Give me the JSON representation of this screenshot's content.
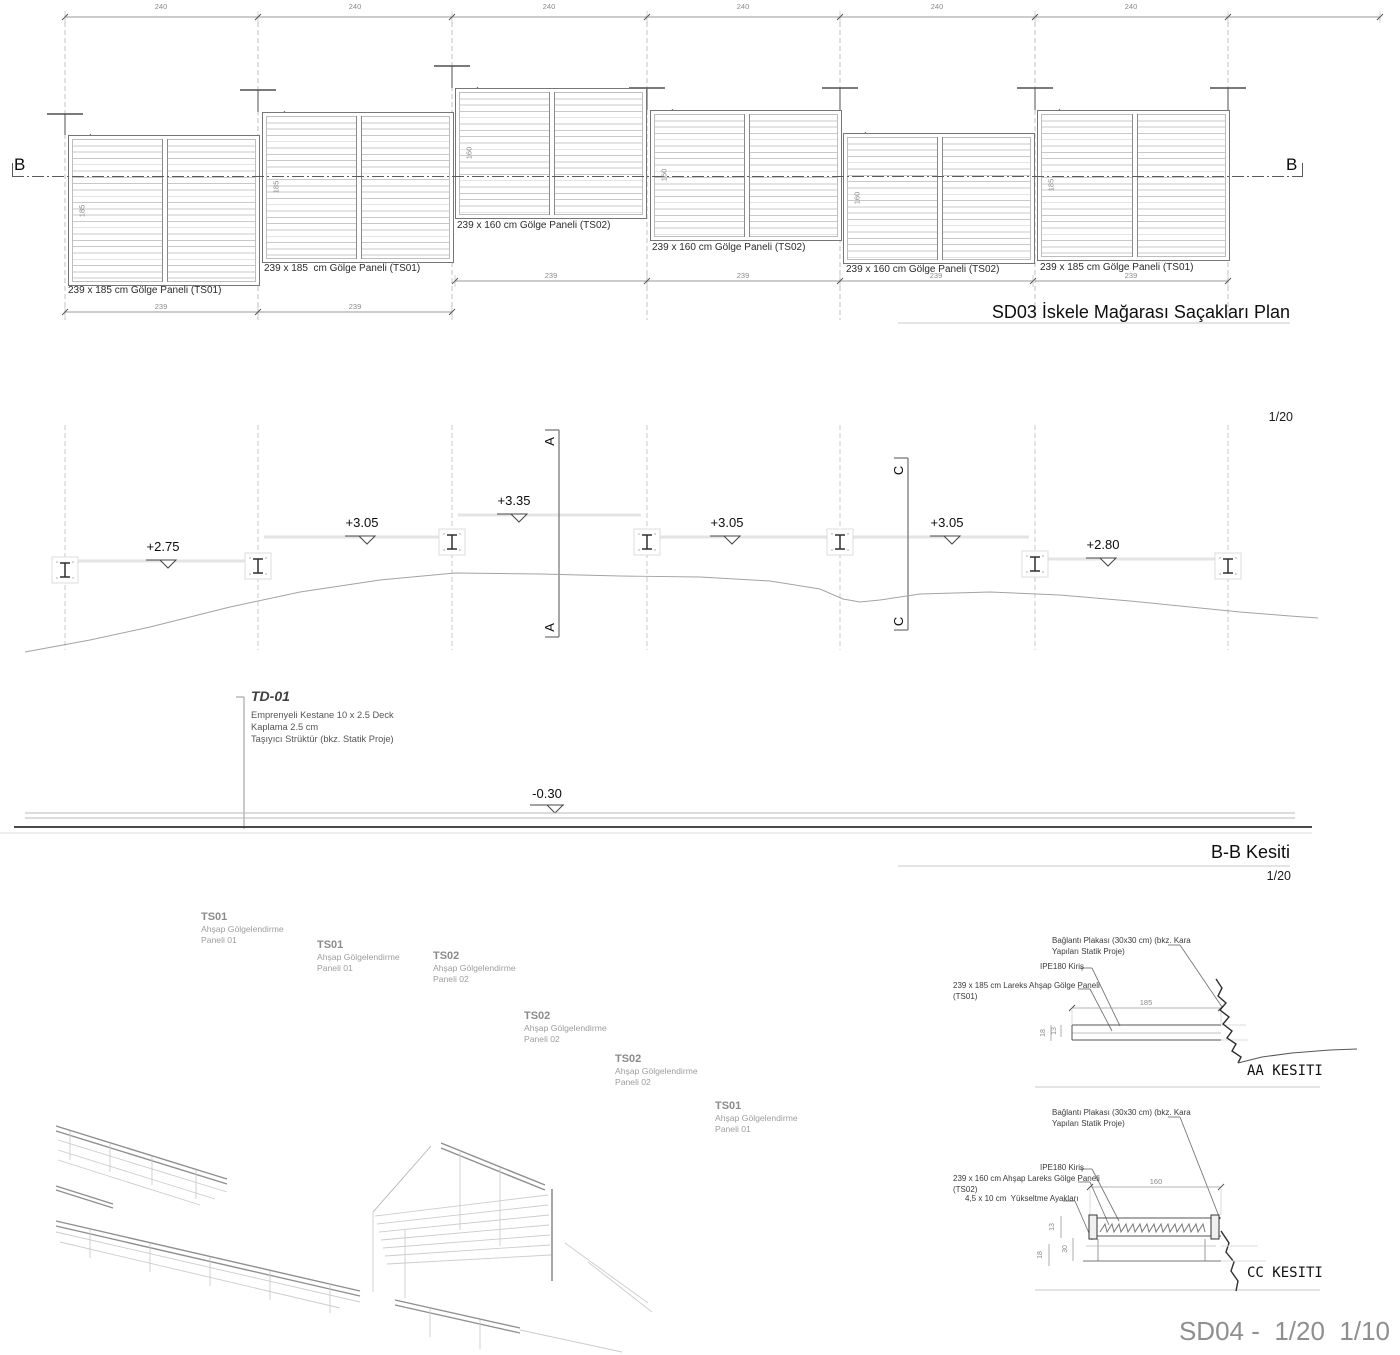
{
  "colors": {
    "ink": "#1a1a1a",
    "dim_gray": "#8a8a8a",
    "footer_gray": "#8f8f8f"
  },
  "plan": {
    "title": "SD03 İskele Mağarası Saçakları Plan",
    "scale": "1/20",
    "marker": "B",
    "top_dims": [
      "240",
      "240",
      "240",
      "240",
      "240",
      "240"
    ],
    "panels": [
      {
        "label": "239 x 185 cm Gölge Paneli (TS01)",
        "depth": "185",
        "width": "239"
      },
      {
        "label": "239 x 185  cm Gölge Paneli (TS01)",
        "depth": "185",
        "width": "239"
      },
      {
        "label": "239 x 160 cm Gölge Paneli (TS02)",
        "depth": "160",
        "width": "239"
      },
      {
        "label": "239 x 160 cm Gölge Paneli (TS02)",
        "depth": "160",
        "width": "239"
      },
      {
        "label": "239 x 160 cm Gölge Paneli (TS02)",
        "depth": "160",
        "width": "239"
      },
      {
        "label": "239 x 185 cm Gölge Paneli (TS01)",
        "depth": "185",
        "width": "239"
      }
    ]
  },
  "section": {
    "title": "B-B Kesiti",
    "scale": "1/20",
    "elevations": [
      "+2.75",
      "+3.05",
      "+3.35",
      "+3.05",
      "+3.05",
      "+2.80"
    ],
    "deck_level": "-0.30",
    "cut_a": "A",
    "cut_c": "C",
    "td01": {
      "code": "TD-01",
      "line1": "Emprenyeli Kestane 10 x 2.5 Deck",
      "line2": "Kaplama 2.5 cm",
      "line3": "Taşıyıcı Strüktür (bkz. Statik Proje)"
    }
  },
  "axon": {
    "labels": [
      {
        "code": "TS01",
        "line1": "Ahşap Gölgelendirme",
        "line2": "Paneli 01"
      },
      {
        "code": "TS01",
        "line1": "Ahşap Gölgelendirme",
        "line2": "Paneli 01"
      },
      {
        "code": "TS02",
        "line1": "Ahşap Gölgelendirme",
        "line2": "Paneli 02"
      },
      {
        "code": "TS02",
        "line1": "Ahşap Gölgelendirme",
        "line2": "Paneli 02"
      },
      {
        "code": "TS02",
        "line1": "Ahşap Gölgelendirme",
        "line2": "Paneli 02"
      },
      {
        "code": "TS01",
        "line1": "Ahşap Gölgelendirme",
        "line2": "Paneli 01"
      }
    ]
  },
  "details": {
    "aa": {
      "title": "AA KESITI",
      "plate_note_1": "Bağlantı Plakası (30x30 cm) (bkz. Kara",
      "plate_note_2": "Yapıları Statik Proje)",
      "beam_note": "IPE180 Kiriş",
      "panel_note_1": "239 x 185 cm Lareks Ahşap Gölge Paneli",
      "panel_note_2": "(TS01)",
      "dim_width": "185",
      "dim_total": "18",
      "dim_panel": "13"
    },
    "cc": {
      "title": "CC KESITI",
      "plate_note_1": "Bağlantı Plakası (30x30 cm) (bkz. Kara",
      "plate_note_2": "Yapıları Statik Proje)",
      "beam_note": "IPE180 Kiriş",
      "panel_note_1": "239 x 160 cm Ahşap Lareks Gölge Paneli",
      "panel_note_2": "(TS02)",
      "riser_note": "4,5 x 10 cm  Yükseltme Ayakları",
      "dim_width": "160",
      "dim_panel": "13",
      "dim_riser": "30",
      "dim_beam": "18"
    }
  },
  "footer": {
    "text": "SD04 -  1/20  1/10"
  }
}
